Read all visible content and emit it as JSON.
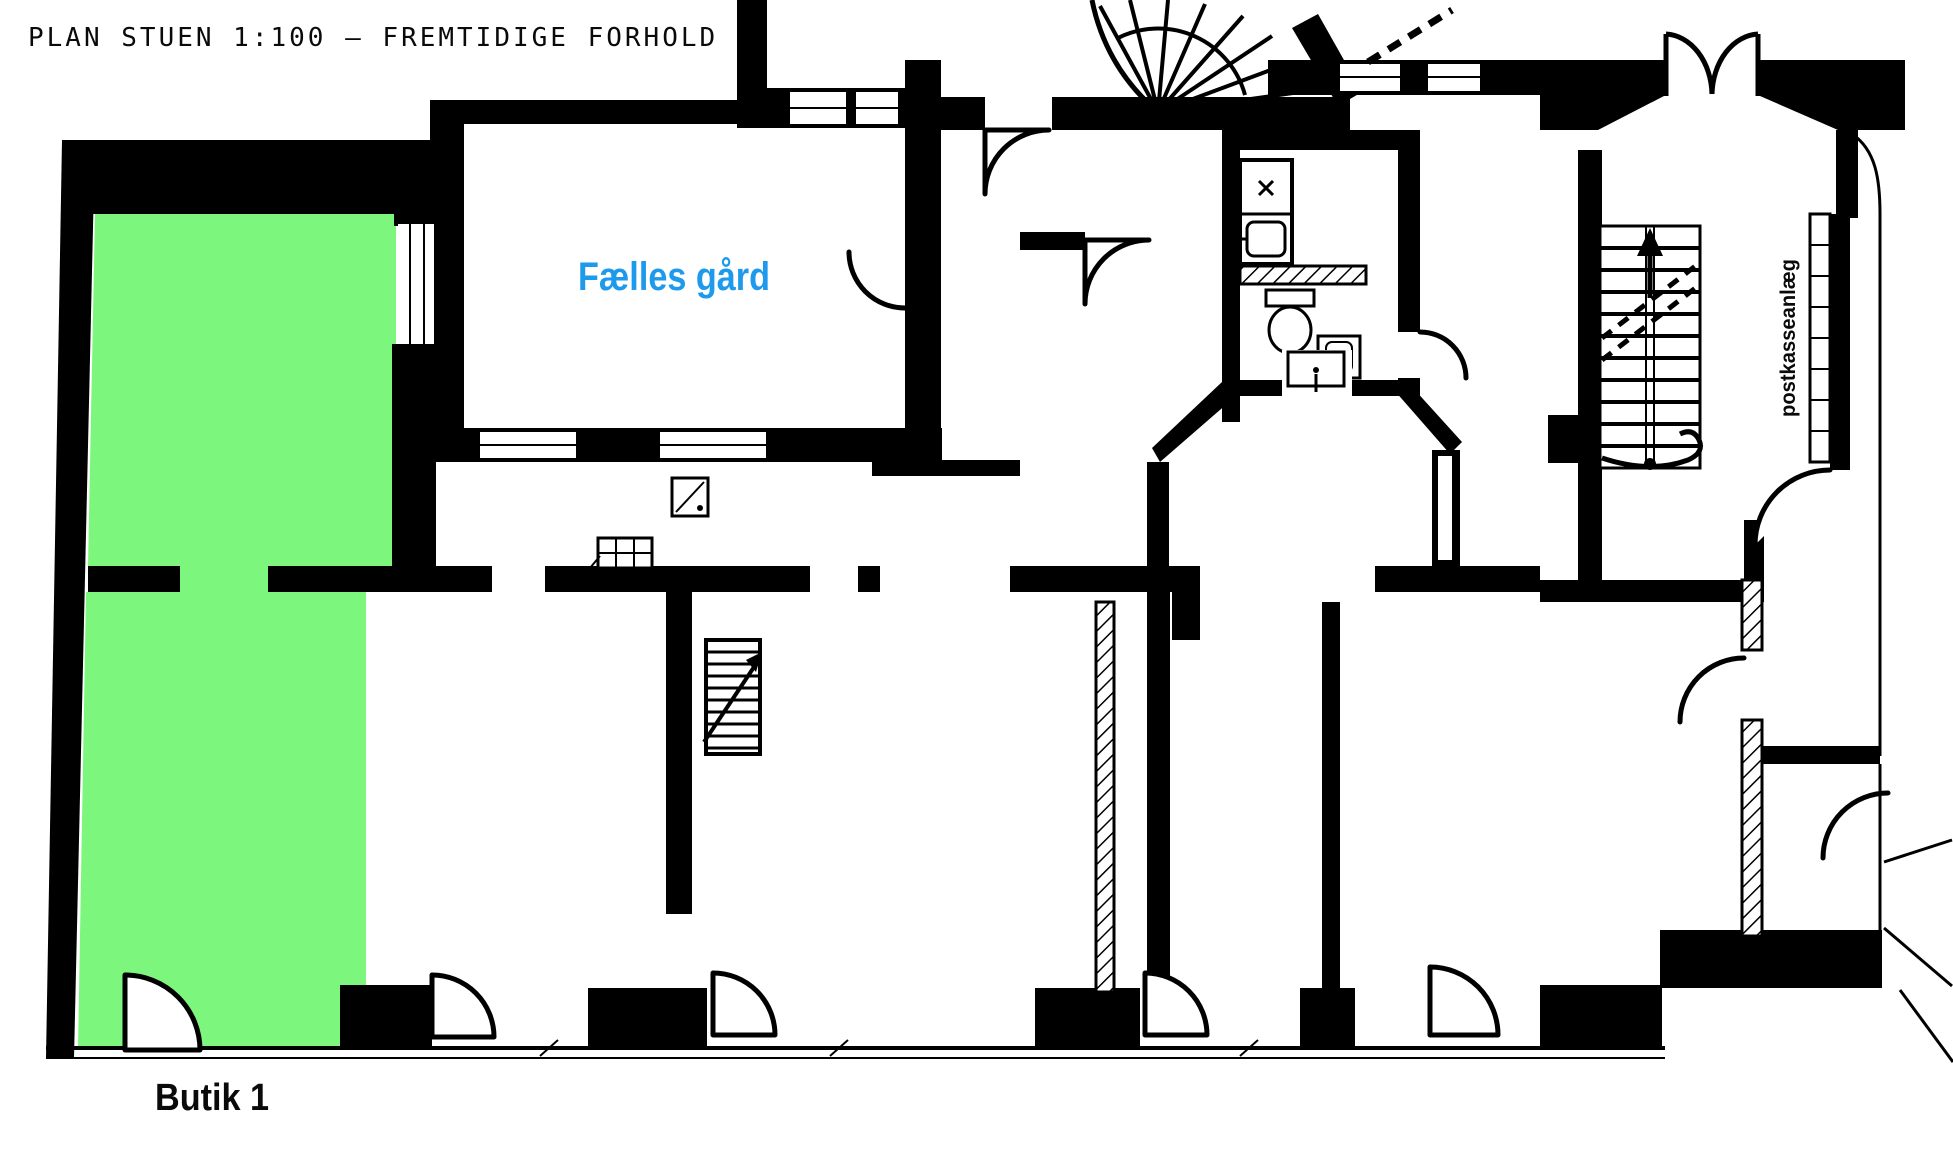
{
  "title": {
    "text": "PLAN STUEN 1:100 – FREMTIDIGE FORHOLD"
  },
  "labels": {
    "courtyard": "Fælles gård",
    "shop": "Butik 1",
    "mailbox": "postkasseanlæg"
  },
  "colors": {
    "wall": "#000000",
    "background": "#ffffff",
    "shop_highlight": "#7df67d",
    "courtyard_label": "#1e9aec",
    "text": "#0a0a0a"
  }
}
